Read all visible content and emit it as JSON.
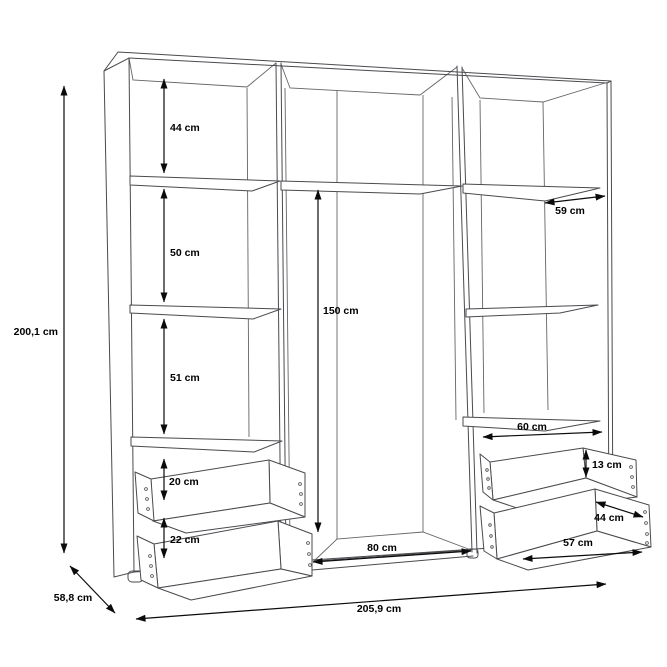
{
  "theme": {
    "background": "#ffffff",
    "furniture_line": "#4a4a4f",
    "dimension_line": "#0b0b0b",
    "label_text": "#000000"
  },
  "diagram": {
    "overall": {
      "height": "200,1 cm",
      "depth": "58,8 cm",
      "width": "205,9 cm"
    },
    "left_column": {
      "compartment_top": "44 cm",
      "compartment_middle": "50 cm",
      "compartment_bottom": "51 cm",
      "drawer_upper": "20 cm",
      "drawer_lower": "22 cm"
    },
    "middle_column": {
      "hanging_height": "150 cm",
      "width": "80 cm"
    },
    "right_column": {
      "shelf_depth": "59 cm",
      "shelf_width": "60 cm",
      "drawer_height": "13 cm",
      "drawer_depth": "44 cm",
      "drawer_width": "57 cm"
    }
  }
}
